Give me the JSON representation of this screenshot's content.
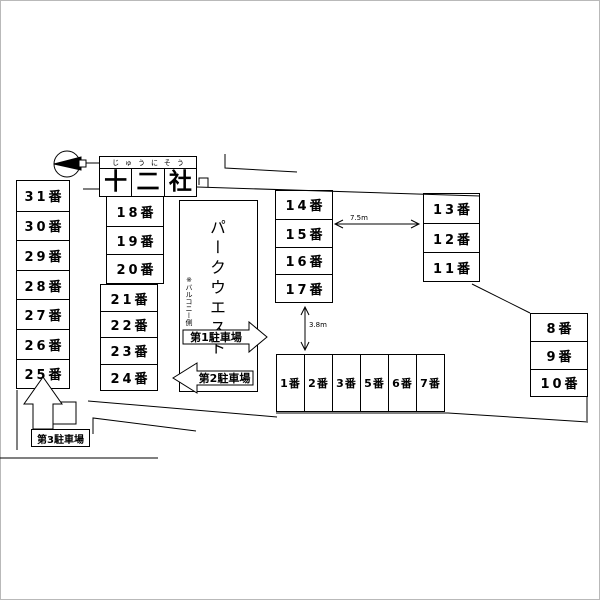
{
  "map": {
    "title": {
      "furigana": "じゅうにそう",
      "kanji": [
        "十",
        "二",
        "社"
      ]
    },
    "building": {
      "name": "パークウエスト",
      "note": "※バルコニー側"
    },
    "spaces": {
      "left": [
        "31番",
        "30番",
        "29番",
        "28番",
        "27番",
        "26番",
        "25番"
      ],
      "middle_upper": [
        "18番",
        "19番",
        "20番"
      ],
      "middle_lower": [
        "21番",
        "22番",
        "23番",
        "24番"
      ],
      "inner_right": [
        "14番",
        "15番",
        "16番",
        "17番"
      ],
      "outer_right": [
        "13番",
        "12番",
        "11番"
      ],
      "far_right": [
        "8番",
        "9番",
        "10番"
      ],
      "bottom_row": [
        "1番",
        "2番",
        "3番",
        "5番",
        "6番",
        "7番"
      ]
    },
    "lots": {
      "lot1": "第1駐車場",
      "lot2": "第2駐車場",
      "lot3": "第3駐車場"
    },
    "dimensions": {
      "road_width": "7.5m",
      "aisle_width": "3.8m"
    },
    "icons": {
      "compass": "north-arrow"
    },
    "colors": {
      "line": "#000000",
      "background": "#ffffff"
    }
  }
}
